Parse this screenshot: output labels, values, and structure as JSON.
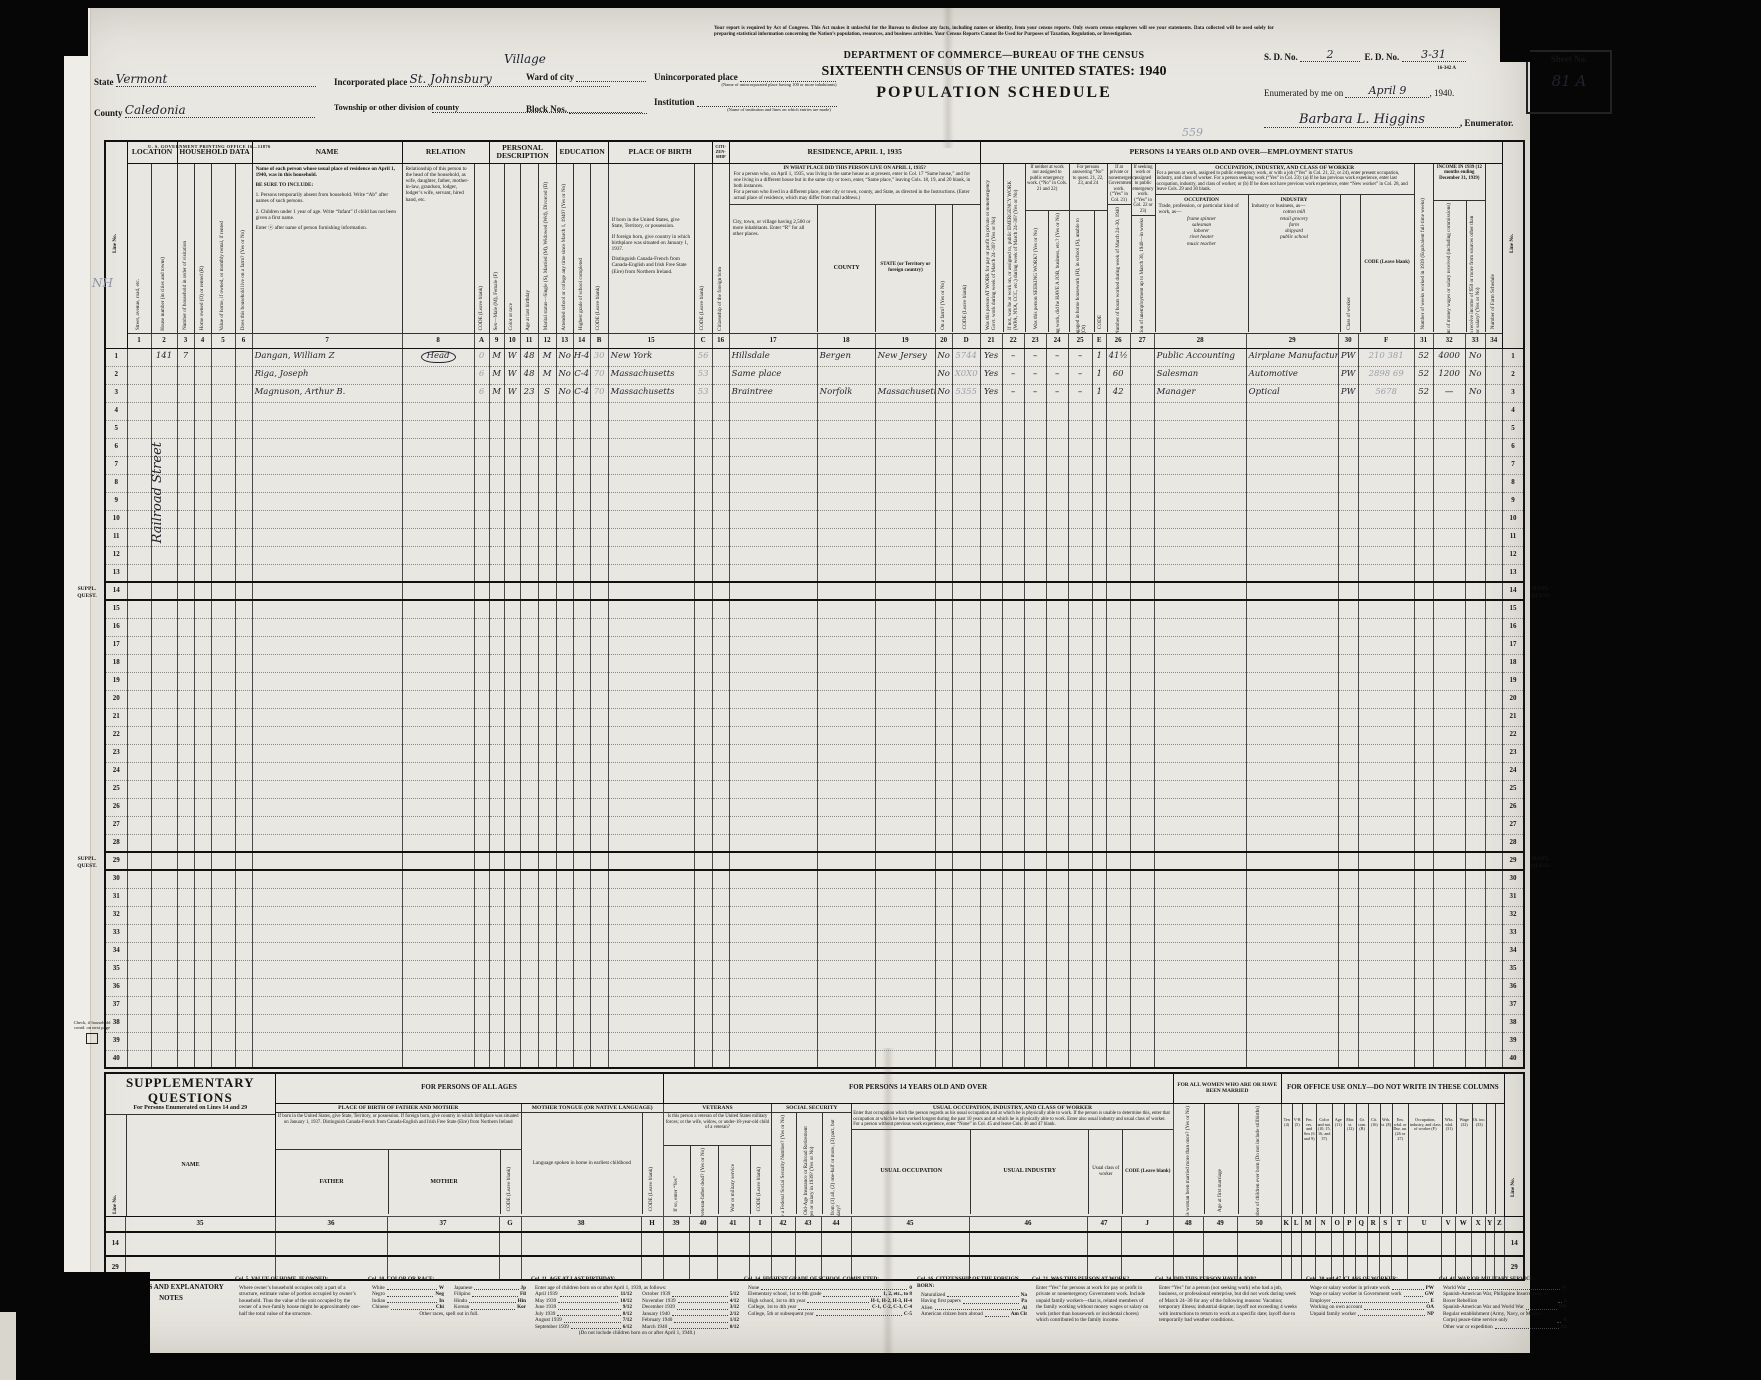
{
  "header": {
    "form_number": "16-342 A",
    "legal": "Your report is required by Act of Congress. This Act makes it unlawful for the Bureau to disclose any facts, including names or identity, from your census reports. Only sworn census employees will see your statements. Data collected will be used solely for preparing statistical information concerning the Nation’s population, resources, and business activities. Your Census Reports Cannot Be Used for Purposes of Taxation, Regulation, or Investigation.",
    "dept": "DEPARTMENT OF COMMERCE—BUREAU OF THE CENSUS",
    "census_title": "SIXTEENTH CENSUS OF THE UNITED STATES: 1940",
    "schedule_title": "POPULATION SCHEDULE",
    "state_label": "State",
    "state_value": "Vermont",
    "county_label": "County",
    "county_value": "Caledonia",
    "incorporated_label": "Incorporated place",
    "incorporated_value": "St. Johnsbury",
    "incorporated_note": "Village",
    "ward_label": "Ward of city",
    "township_label": "Township or other division of county",
    "block_label": "Block Nos.",
    "unincorporated_label": "Unincorporated place",
    "unincorporated_caption": "(Name of unincorporated place having 100 or more inhabitants)",
    "institution_label": "Institution",
    "institution_caption": "(Name of institution and lines on which entries are made)",
    "sd_label": "S. D. No.",
    "sd_value": "2",
    "ed_label": "E. D. No.",
    "ed_value": "3-31",
    "sheet_label": "Sheet No.",
    "sheet_value": "81 A",
    "enumerated_label": "Enumerated by me on",
    "enumerated_date": "April 9",
    "enumerated_year": ", 1940.",
    "enumerator_name": "Barbara L. Higgins",
    "enumerator_label": ", Enumerator.",
    "pencil_scribble": "559",
    "gpo_line": "U. S. GOVERNMENT PRINTING OFFICE      16—11876"
  },
  "grid": {
    "line_no_label": "Line No.",
    "groups": {
      "location": "LOCATION",
      "household": "HOUSEHOLD DATA",
      "name": "NAME",
      "relation": "RELATION",
      "personal": "PERSONAL DESCRIPTION",
      "education": "EDUCATION",
      "birth": "PLACE OF BIRTH",
      "citizenship_tiny": "CITI- ZEN- SHIP",
      "residence": "RESIDENCE, APRIL 1, 1935",
      "employment": "PERSONS 14 YEARS OLD AND OVER—EMPLOYMENT STATUS",
      "g2324": "If neither at work nor assigned to public emergency work. (“No” in Cols. 21 and 22)",
      "g25": "For persons answering “No” to quest. 21, 22, 23, and 24",
      "g26": "If at private or nonemergency Government work. (“Yes” in Col. 21)",
      "g27": "If seeking work or assigned to public emergency work. (“Yes” in Col. 22 or 23)",
      "occ_title": "OCCUPATION, INDUSTRY, AND CLASS OF WORKER",
      "occ_text": "For a person at work, assigned to public emergency work, or with a job (“Yes” in Col. 21, 22, or 24), enter present occupation, industry, and class of worker. For a person seeking work (“Yes” in Col. 23): (a) If he has previous work experience, enter last occupation, industry, and class of worker; or (b) If he does not have previous work experience, enter “New worker” in Col. 28, and leave Cols. 29 and 30 blank.",
      "income": "INCOME IN 1939 (12 months ending December 31, 1939)"
    },
    "residence_q": "IN WHAT PLACE DID THIS PERSON LIVE ON APRIL 1, 1935?",
    "residence_p1": "For a person who, on April 1, 1935, was living in the same house as at present, enter in Col. 17 “Same house,” and for one living in a different house but in the same city or town, enter, “Same place,” leaving Cols. 18, 19, and 20 blank, in both instances.",
    "residence_p2": "For a person who lived in a different place, enter city or town, county, and State, as directed in the Instructions.  (Enter actual place of residence, which may differ from mail address.)",
    "name_block": {
      "lead": "Name of each person whose usual place of residence on April 1, 1940, was in this household.",
      "include": "BE SURE TO INCLUDE:",
      "inc1": "1. Persons temporarily absent from household. Write “Ab” after names of such persons.",
      "inc2": "2. Children under 1 year of age. Write “Infant” if child has not been given a first name.",
      "info": "Enter ⓧ after name of person furnishing information."
    },
    "pob": {
      "p1": "If born in the United States, give State, Territory, or possession.",
      "p2": "If foreign born, give country in which birthplace was situated on January 1, 1937.",
      "p3": "Distinguish Canada-French from Canada-English and Irish Free State (Eire) from Northern Ireland."
    },
    "occ28": {
      "title": "OCCUPATION",
      "text": "Trade, profession, or particular kind of work, as—",
      "examples": [
        "frame spinner",
        "salesman",
        "laborer",
        "rivet heater",
        "music teacher"
      ]
    },
    "ind29": {
      "title": "INDUSTRY",
      "text": "Industry or business, as—",
      "examples": [
        "cotton mill",
        "retail grocery",
        "farm",
        "shipyard",
        "public school"
      ]
    },
    "labels": {
      "c1": "Street, avenue, road, etc.",
      "c2": "House number (in cities and towns)",
      "c3": "Number of household in order of visitation",
      "c4": "Home owned (O) or rented (R)",
      "c5": "Value of home, if owned, or monthly rental, if rented",
      "c6": "Does this household live on a farm? (Yes or No)",
      "c8": "Relationship of this person to the head of the household, as wife, daughter, father, mother-in-law, grandson, lodger, lodger’s wife, servant, hired hand, etc.",
      "cA": "CODE (Leave blank)",
      "c9": "Sex—Male (M), Female (F)",
      "c10": "Color or race",
      "c11": "Age at last birthday",
      "c12": "Marital status—Single (S), Married (M), Widowed (Wd), Divorced (D)",
      "c13": "Attended school or college any time since March 1, 1940? (Yes or No)",
      "c14": "Highest grade of school completed",
      "cB": "CODE (Leave blank)",
      "cC": "CODE (Leave blank)",
      "c16": "Citizenship of the foreign born",
      "c17": "City, town, or village having 2,500 or more inhabitants. Enter “R” for all other places.",
      "c18": "COUNTY",
      "c19": "STATE (or Territory or foreign country)",
      "c20": "On a farm? (Yes or No)",
      "cD": "CODE (Leave blank)",
      "c21": "Was this person AT WORK for pay or profit in private or nonemergency Govt. work during week of March 24–30? (Yes or No)",
      "c22": "If not, was he at work on, or assigned to, public EMERGENCY WORK (WPA, NYA, CCC, etc.) during week of March 24–30? (Yes or No)",
      "c23": "Was this person SEEKING WORK? (Yes or No)",
      "c24": "If not seeking work, did he HAVE A JOB, business, etc.? (Yes or No)",
      "c25": "Indicate whether engaged in home housework (H), in school (S), unable to work (U), or other (Ot)",
      "cE": "CODE",
      "c26": "Number of hours worked during week of March 24–30, 1940",
      "c27": "Duration of unemployment up to March 30, 1940—in weeks",
      "c30": "Class of worker",
      "cF": "CODE (Leave blank)",
      "c31": "Number of weeks worked in 1939 (Equivalent full-time weeks)",
      "c32": "Amount of money wages or salary received (including commissions)",
      "c33": "Did this person receive income of $50 or more from sources other than money wages or salary? (Yes or No)",
      "c34": "Number of Farm Schedule"
    },
    "col_nums": [
      "1",
      "2",
      "3",
      "4",
      "5",
      "6",
      "7",
      "8",
      "A",
      "9",
      "10",
      "11",
      "12",
      "13",
      "14",
      "B",
      "15",
      "C",
      "16",
      "17",
      "18",
      "19",
      "20",
      "D",
      "21",
      "22",
      "23",
      "24",
      "25",
      "E",
      "26",
      "27",
      "28",
      "29",
      "30",
      "F",
      "31",
      "32",
      "33",
      "34"
    ],
    "rows": [
      {
        "n": "1",
        "circled": "c8",
        "cells": {
          "c2": "141",
          "c3": "7",
          "c7": "Dangan, William Z",
          "c8": "Head",
          "cA": "0",
          "c9": "M",
          "c10": "W",
          "c11": "48",
          "c12": "M",
          "c13": "No",
          "c14": "H-4",
          "cB": "30",
          "c15": "New York",
          "cC": "56",
          "c17": "Hillsdale",
          "c18": "Bergen",
          "c19": "New Jersey",
          "c20": "No",
          "cD": "5744",
          "c21": "Yes",
          "c22": "–",
          "c23": "–",
          "c24": "–",
          "c25": "–",
          "cE": "1",
          "c26": "41½",
          "c28": "Public Accounting",
          "c29": "Airplane Manufacturing",
          "c30": "PW",
          "cF": "210 381",
          "c31": "52",
          "c32": "4000",
          "c33": "No"
        }
      },
      {
        "n": "2",
        "cells": {
          "c7": "Riga, Joseph",
          "cA": "6",
          "c9": "M",
          "c10": "W",
          "c11": "48",
          "c12": "M",
          "c13": "No",
          "c14": "C-4",
          "cB": "70",
          "c15": "Massachusetts",
          "cC": "53",
          "c17": "Same place",
          "c20": "No",
          "cD": "X0X0",
          "c21": "Yes",
          "c22": "–",
          "c23": "–",
          "c24": "–",
          "c25": "–",
          "cE": "1",
          "c26": "60",
          "c28": "Salesman",
          "c29": "Automotive",
          "c30": "PW",
          "cF": "2898 69",
          "c31": "52",
          "c32": "1200",
          "c33": "No"
        }
      },
      {
        "n": "3",
        "cells": {
          "c7": "Magnuson, Arthur B.",
          "cA": "6",
          "c9": "M",
          "c10": "W",
          "c11": "23",
          "c12": "S",
          "c13": "No",
          "c14": "C-4",
          "cB": "70",
          "c15": "Massachusetts",
          "cC": "53",
          "c17": "Braintree",
          "c18": "Norfolk",
          "c19": "Massachusetts",
          "c20": "No",
          "cD": "5355",
          "c21": "Yes",
          "c22": "–",
          "c23": "–",
          "c24": "–",
          "c25": "–",
          "cE": "1",
          "c26": "42",
          "c28": "Manager",
          "c29": "Optical",
          "c30": "PW",
          "cF": "5678",
          "c31": "52",
          "c32": "—",
          "c33": "No"
        }
      },
      {
        "n": "4"
      },
      {
        "n": "5"
      },
      {
        "n": "6"
      },
      {
        "n": "7"
      },
      {
        "n": "8"
      },
      {
        "n": "9"
      },
      {
        "n": "10"
      },
      {
        "n": "11"
      },
      {
        "n": "12"
      },
      {
        "n": "13"
      },
      {
        "n": "14",
        "suppl": true
      },
      {
        "n": "15"
      },
      {
        "n": "16"
      },
      {
        "n": "17"
      },
      {
        "n": "18"
      },
      {
        "n": "19"
      },
      {
        "n": "20"
      },
      {
        "n": "21"
      },
      {
        "n": "22"
      },
      {
        "n": "23"
      },
      {
        "n": "24"
      },
      {
        "n": "25"
      },
      {
        "n": "26"
      },
      {
        "n": "27"
      },
      {
        "n": "28"
      },
      {
        "n": "29",
        "suppl": true
      },
      {
        "n": "30"
      },
      {
        "n": "31"
      },
      {
        "n": "32"
      },
      {
        "n": "33"
      },
      {
        "n": "34"
      },
      {
        "n": "35"
      },
      {
        "n": "36"
      },
      {
        "n": "37"
      },
      {
        "n": "38"
      },
      {
        "n": "39"
      },
      {
        "n": "40"
      }
    ]
  },
  "margins": {
    "nh": "NH",
    "street": "Railroad Street",
    "suppl": "SUPPL. QUEST.",
    "check_note": "Check, if household contd. on next page"
  },
  "supp": {
    "title": "SUPPLEMENTARY QUESTIONS",
    "subtitle": "For Persons Enumerated on Lines 14 and 29",
    "line_no_label": "Line No.",
    "all_ages": "FOR PERSONS OF ALL AGES",
    "fourteen_over": "FOR PERSONS 14 YEARS OLD AND OVER",
    "women": "FOR ALL WOMEN WHO ARE OR HAVE BEEN MARRIED",
    "office": "FOR OFFICE USE ONLY—DO NOT WRITE IN THESE COLUMNS",
    "name_label": "NAME",
    "pob_title": "PLACE OF BIRTH OF FATHER AND MOTHER",
    "pob_text": "If born in the United States, give State, Territory, or possession. If foreign born, give country in which birthplace was situated on January 1, 1937. Distinguish Canada-French from Canada-English and Irish Free State (Eire) from Northern Ireland",
    "father": "FATHER",
    "mother": "MOTHER",
    "codeG": "CODE (Leave blank)",
    "tongue_title": "MOTHER TONGUE (OR NATIVE LANGUAGE)",
    "tongue_text": "Language spoken in home in earliest childhood",
    "codeH": "CODE (Leave blank)",
    "vet_title": "VETERANS",
    "vet_text": "Is this person a veteran of the United States military forces; or the wife, widow, or under-18-year-old child of a veteran?",
    "c39": "If so, enter “Yes”",
    "c40": "If child, is veteran-father dead? (Yes or No)",
    "c41": "War or military service",
    "codeI": "CODE (Leave blank)",
    "ss_title": "SOCIAL SECURITY",
    "c42": "Does this person have a Federal Social Security Number? (Yes or No)",
    "c43": "Were deductions for Federal Old-Age Insurance or Railroad Retirement made from this person’s wages or salary in 1939? (Yes or No)",
    "c44": "If so, were deductions made from (1) all, (2) one-half or more, (3) part, but less than half, of wages or salary?",
    "usual_title": "USUAL OCCUPATION, INDUSTRY, AND CLASS OF WORKER",
    "usual_text": "Enter that occupation which the person regards as his usual occupation and at which he is physically able to work. If the person is unable to determine this, enter that occupation at which he has worked longest during the past 10 years and at which he is physically able to work. Enter also usual industry and usual class of worker.",
    "usual_text2": "For a person without previous work experience, enter “None” in Col. 45 and leave Cols. 46 and 47 blank.",
    "c45": "USUAL OCCUPATION",
    "c46": "USUAL INDUSTRY",
    "c47": "Usual class of worker",
    "codeJ": "CODE (Leave blank)",
    "c48": "Has this woman been married more than once? (Yes or No)",
    "c49": "Age at first marriage",
    "c50": "Number of children ever born (Do not include stillbirths)",
    "office_cols": [
      "Ten (4)",
      "V-R (5)",
      "Fm. res. and Sex (6 and 9)",
      "Color and nat. (10, 15, 16, and 37)",
      "Age (11)",
      "Mar. st. (12)",
      "Gr. com. (R)",
      "Cit. (16)",
      "Wrk. st. (E)",
      "Em. wkd. or Dur. un. (26 or 27)",
      "Occupation, industry, and class of worker (F)",
      "Wks. wkd. (31)",
      "Wage (32)",
      "Ot. inc. (33)",
      "",
      ""
    ],
    "col_nums": [
      "35",
      "36",
      "37",
      "G",
      "38",
      "H",
      "39",
      "40",
      "41",
      "I",
      "42",
      "43",
      "44",
      "45",
      "46",
      "47",
      "J",
      "48",
      "49",
      "50",
      "K",
      "L",
      "M",
      "N",
      "O",
      "P",
      "Q",
      "R",
      "S",
      "T",
      "U",
      "V",
      "W",
      "X",
      "Y",
      "Z"
    ],
    "rows": [
      "14",
      "29"
    ]
  },
  "notes": {
    "symbols_title": "SYMBOLS AND EXPLANATORY NOTES",
    "col5_title": "Col. 5. VALUE OF HOME, IF OWNED:",
    "col5_text": "Where owner’s household occupies only a part of a structure, estimate value of portion occupied by owner’s household. Thus the value of the unit occupied by the owner of a two-family house might be approximately one-half the total value of the structure.",
    "col10_title": "Col. 10. COLOR OR RACE:",
    "col10_items": [
      [
        "White",
        "W"
      ],
      [
        "Negro",
        "Neg"
      ],
      [
        "Indian",
        "In"
      ],
      [
        "Chinese",
        "Chi"
      ],
      [
        "Japanese",
        "Jp"
      ],
      [
        "Filipino",
        "Fil"
      ],
      [
        "Hindu",
        "Hin"
      ],
      [
        "Korean",
        "Kor"
      ]
    ],
    "col10_other": "Other races, spell out in full.",
    "col11_title": "Col. 11. AGE AT LAST BIRTHDAY:",
    "col11_intro": "Enter age of children born on or after April 1, 1939, as follows:",
    "col11_items": [
      [
        "April 1939",
        "11/12"
      ],
      [
        "May 1939",
        "10/12"
      ],
      [
        "June 1939",
        "9/12"
      ],
      [
        "July 1939",
        "8/12"
      ],
      [
        "August 1939",
        "7/12"
      ],
      [
        "September 1939",
        "6/12"
      ],
      [
        "October 1939",
        "5/12"
      ],
      [
        "November 1939",
        "4/12"
      ],
      [
        "December 1939",
        "3/12"
      ],
      [
        "January 1940",
        "2/12"
      ],
      [
        "February 1940",
        "1/12"
      ],
      [
        "March 1940",
        "0/12"
      ]
    ],
    "col11_footer": "(Do not include children born on or after April 1, 1940.)",
    "col14_title": "Col. 14. HIGHEST GRADE OF SCHOOL COMPLETED:",
    "col14_items": [
      [
        "None",
        "0"
      ],
      [
        "Elementary school, 1st to 8th grade",
        "1, 2, etc., to 8"
      ],
      [
        "High school, 1st to 4th year",
        "H-1, H-2, H-3, H-4"
      ],
      [
        "College, 1st to 4th year",
        "C-1, C-2, C-3, C-4"
      ],
      [
        "College, 5th or subsequent year",
        "C-5"
      ]
    ],
    "col16_title": "Col. 16. CITIZENSHIP OF THE FOREIGN BORN:",
    "col16_items": [
      [
        "Naturalized",
        "Na"
      ],
      [
        "Having first papers",
        "Pa"
      ],
      [
        "Alien",
        "Al"
      ],
      [
        "American citizen born abroad",
        "Am Cit"
      ]
    ],
    "col21_title": "Col. 21. WAS THIS PERSON AT WORK?",
    "col21_text": "Enter “Yes” for persons at work for pay or profit in private or nonemergency Government work. Include unpaid family workers—that is, related members of the family working without money wages or salary on work (other than housework or incidental chores) which contributed to the family income.",
    "col24_title": "Col. 24. DID THIS PERSON HAVE A JOB?",
    "col24_text": "Enter “Yes” for a person (not seeking work) who had a job, business, or professional enterprise, but did not work during week of March 24–30 for any of the following reasons: Vacation; temporary illness; industrial dispute; layoff not exceeding 4 weeks with instructions to return to work at a specific date; layoff due to temporarily bad weather conditions.",
    "col3047_title": "Cols. 30 and 47. CLASS OF WORKER:",
    "col3047_items": [
      [
        "Wage or salary worker in private work",
        "PW"
      ],
      [
        "Wage or salary worker in Government work",
        "GW"
      ],
      [
        "Employer",
        "E"
      ],
      [
        "Working on own account",
        "OA"
      ],
      [
        "Unpaid family worker",
        "NP"
      ]
    ],
    "col41_title": "Col. 41. WAR OR MILITARY SERVICE:",
    "col41_items": [
      [
        "World War",
        "W"
      ],
      [
        "Spanish-American War, Philippine Insurrection, or Boxer Rebellion",
        "S"
      ],
      [
        "Spanish-American War and World War",
        "SW"
      ],
      [
        "Regular establishment (Army, Navy, or Marine Corps) peace-time service only",
        "R"
      ],
      [
        "Other war or expedition",
        "Ot"
      ]
    ]
  }
}
